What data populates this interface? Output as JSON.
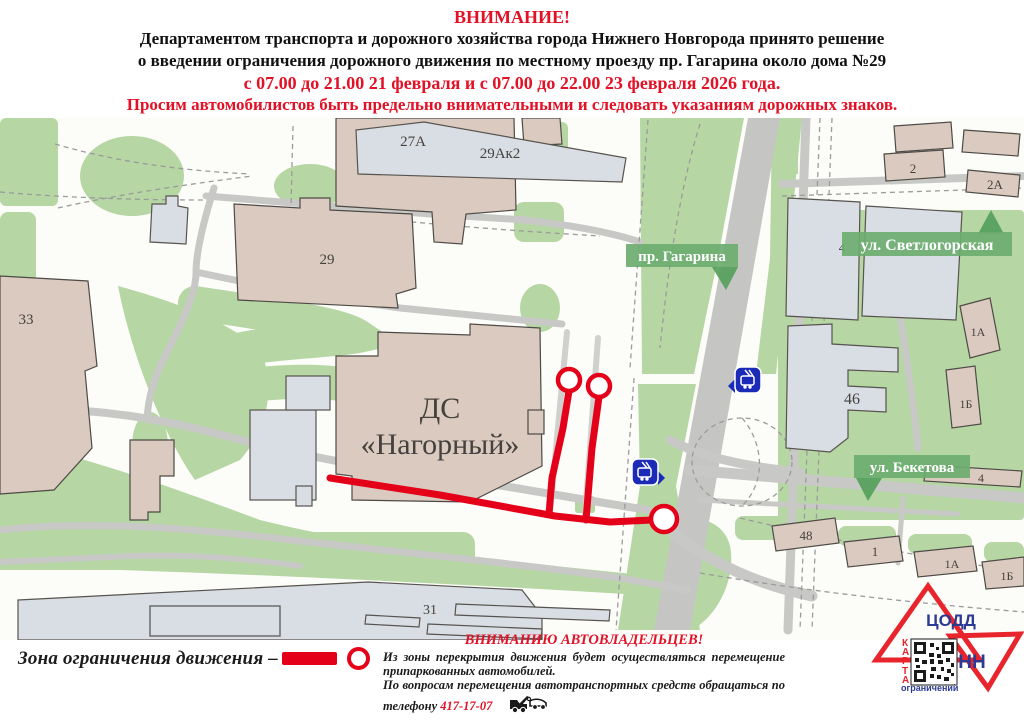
{
  "header": {
    "line1": "ВНИМАНИЕ!",
    "line2": "Департаментом транспорта и дорожного хозяйства города Нижнего Новгорода принято решение",
    "line3": "о введении ограничения дорожного движения по местному проезду пр. Гагарина около дома №29",
    "line4": "с 07.00 до 21.00 21 февраля и с 07.00 до 22.00 23 февраля 2026 года.",
    "line5": "Просим автомобилистов быть предельно внимательными и следовать указаниям дорожных знаков."
  },
  "map": {
    "signs": {
      "gagarina": "пр. Гагарина",
      "svetlogorskaya": "ул. Светлогорская",
      "beketova": "ул. Бекетова"
    },
    "venue": {
      "line1": "ДС",
      "line2": "«Нагорный»"
    },
    "labels": {
      "b29ak2": "29Ак2",
      "b27a": "27А",
      "b29": "29",
      "b33": "33",
      "b31": "31",
      "b2": "2",
      "b2a": "2А",
      "b4_svet": "4",
      "b46": "46",
      "b1a_right": "1А",
      "b1b_right": "1Б",
      "b4_beketova": "4",
      "b48": "48",
      "b1": "1",
      "b1a_bottom": "1А",
      "b1b_bottom": "1Б"
    },
    "transit_icon": "trolleybus-stop-icon"
  },
  "legend": {
    "label": "Зона ограничения движения –"
  },
  "notice": {
    "title": "ВНИМАНИЮ АВТОВЛАДЕЛЬЦЕВ!",
    "p1": "Из зоны перекрытия движения будет осуществляться перемещение припаркованных автомобилей.",
    "p2_prefix": "По вопросам перемещения автотранспортных средств обращаться по телефону",
    "phone": "417-17-07"
  },
  "logo": {
    "codd": "ЦОДД",
    "nn": "НН",
    "karta": "КАРТА",
    "sub": "ограничений"
  },
  "colors": {
    "alert_red": "#e31126",
    "restriction_red": "#e50019",
    "map_green": "#b6d6a4",
    "sign_green": "#6dac70",
    "road_gray": "#c8c9c6",
    "building_tan": "#dacabf",
    "building_gray": "#dde2e9",
    "transit_blue": "#1b2bb8",
    "logo_red": "#e8252c",
    "logo_blue": "#2b3a92"
  }
}
